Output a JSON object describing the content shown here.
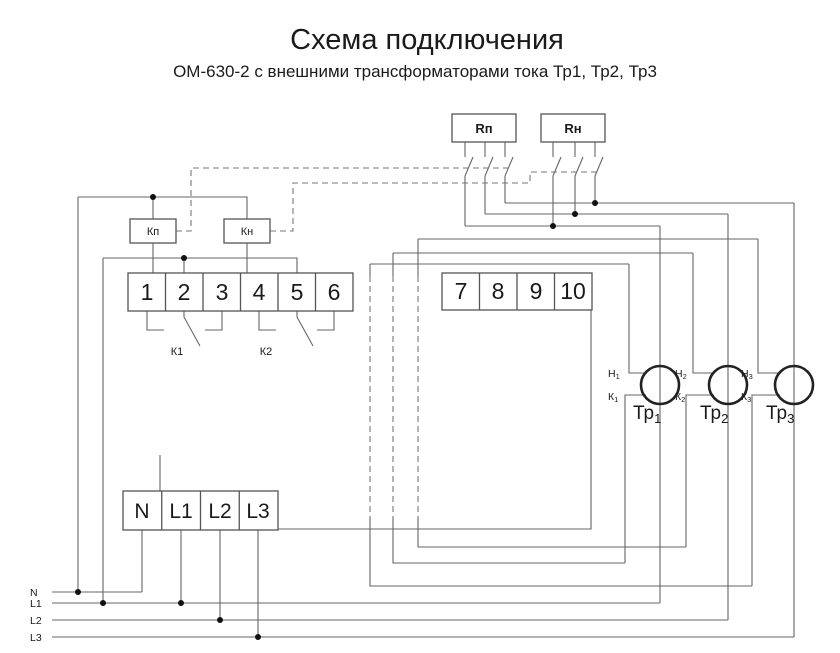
{
  "title": "Схема подключения",
  "subtitle": "ОМ-630-2 с внешними трансформаторами тока Тр1, Тр2, Тр3",
  "relays": {
    "rp": "Rп",
    "rn": "Rн"
  },
  "coils": {
    "kp": "Кп",
    "kn": "Кн"
  },
  "contact_groups": {
    "k1": "К1",
    "k2": "К2"
  },
  "terminal_block_relay": [
    "1",
    "2",
    "3",
    "4",
    "5",
    "6"
  ],
  "terminal_block_current": [
    "7",
    "8",
    "9",
    "10"
  ],
  "terminal_block_power": [
    "N",
    "L1",
    "L2",
    "L3"
  ],
  "buses": {
    "n": "N",
    "l1": "L1",
    "l2": "L2",
    "l3": "L3"
  },
  "transformers": [
    {
      "name": "Тр",
      "index": "1",
      "start": "Н",
      "start_index": "1",
      "end": "К",
      "end_index": "1"
    },
    {
      "name": "Тр",
      "index": "2",
      "start": "Н",
      "start_index": "2",
      "end": "К",
      "end_index": "2"
    },
    {
      "name": "Тр",
      "index": "3",
      "start": "Н",
      "start_index": "3",
      "end": "К",
      "end_index": "3"
    }
  ],
  "colors": {
    "background": "#ffffff",
    "wire": "#666666",
    "dashed_wire": "#777777",
    "box_stroke": "#555555",
    "transformer_stroke": "#222222",
    "text": "#1a1a1a"
  }
}
